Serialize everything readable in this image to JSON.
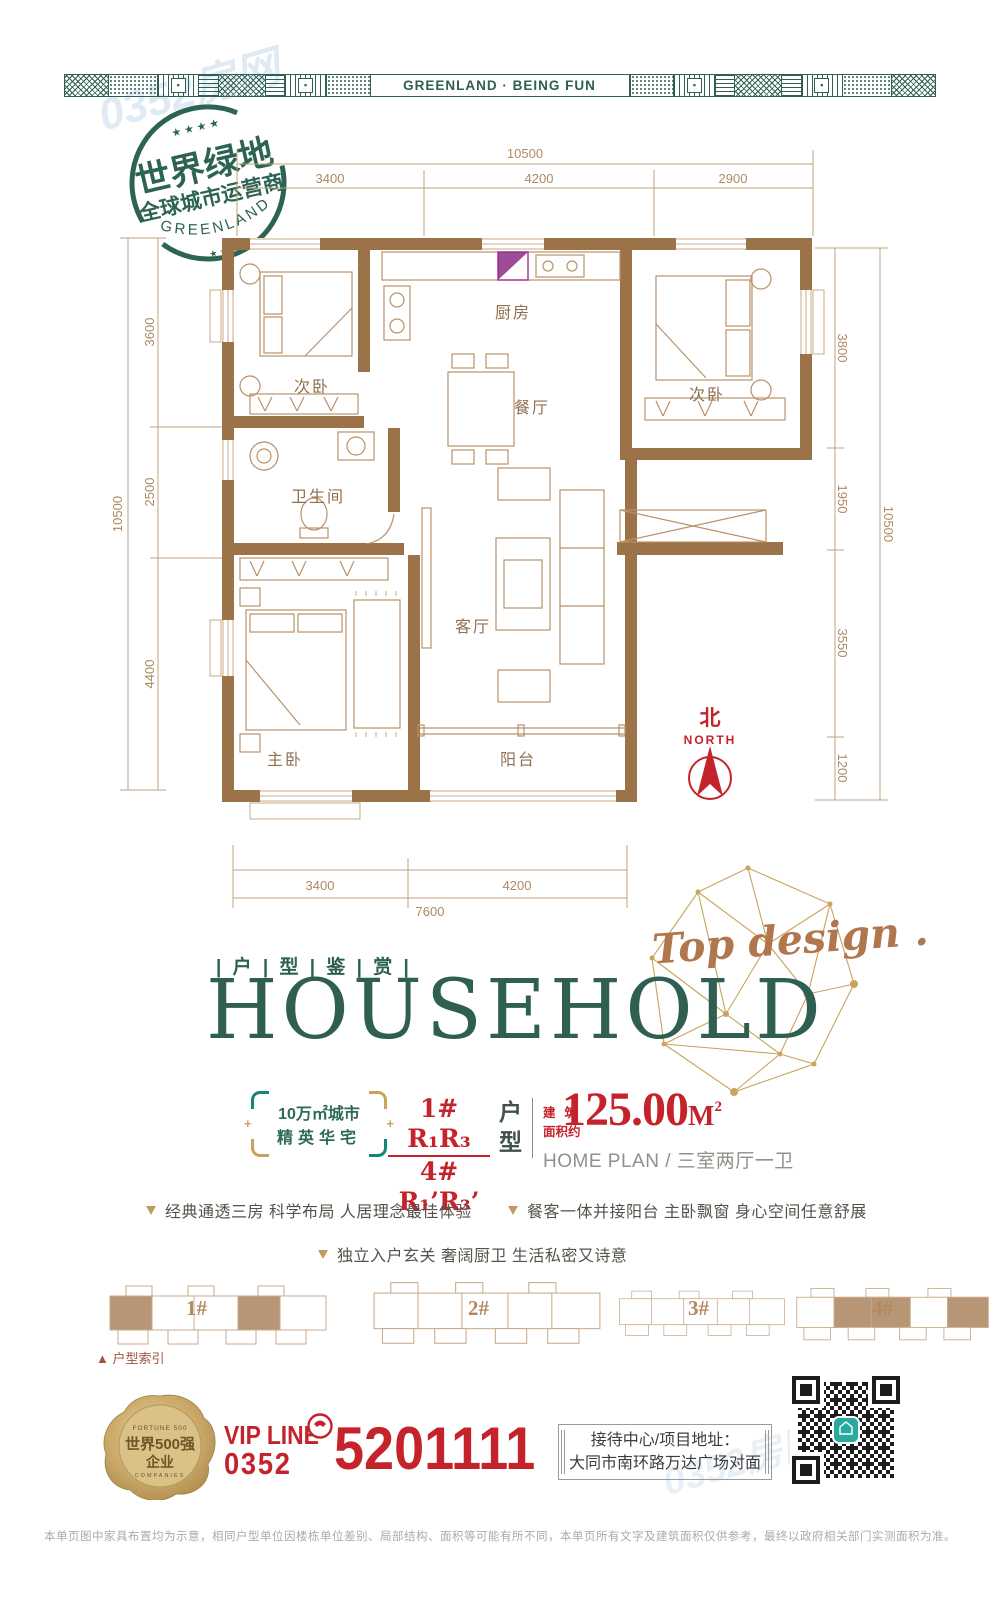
{
  "colors": {
    "brand_green": "#2e5f51",
    "teal": "#16857a",
    "gold": "#c8a35a",
    "red": "#c5232b",
    "wall_brown": "#9c7349",
    "line_brown": "#b9916a",
    "tan": "#b5875f"
  },
  "band": {
    "label": "GREENLAND · BEING FUN"
  },
  "stamp": {
    "stars_top": "★ ★ ★ ★",
    "line1": "世界绿地",
    "line2": "全球城市运营商",
    "arc": "GREENLAND",
    "stars_bottom": "★ ★ ★"
  },
  "plan": {
    "rooms": {
      "bedroom_a": "次卧",
      "kitchen": "厨房",
      "dining": "餐厅",
      "bedroom_b": "次卧",
      "bath": "卫生间",
      "living": "客厅",
      "master": "主卧",
      "balcony": "阳台"
    },
    "north": {
      "cn": "北",
      "en": "NORTH"
    },
    "dims": {
      "top_total": "10500",
      "top": [
        "3400",
        "4200",
        "2900"
      ],
      "left_total": "10500",
      "left": [
        "3600",
        "2500",
        "4400"
      ],
      "right_total": "10500",
      "right": [
        "3800",
        "1950",
        "3550",
        "1200"
      ],
      "bottom": [
        "3400",
        "4200"
      ],
      "bottom_total": "7600"
    }
  },
  "title": {
    "eyebrow": "| 户 | 型 | 鉴 | 赏 |",
    "main": "HOUSEHOLD",
    "script": "Top design ."
  },
  "spec": {
    "badge_line1": "10万㎡城市",
    "badge_line2": "精英华宅",
    "units_top": "1# R₁R₃",
    "units_bottom": "4# R₁’R₃’",
    "type_vertical_1": "户",
    "type_vertical_2": "型",
    "area_label_1": "建筑",
    "area_label_2": "面积约",
    "area_value": "125.00",
    "area_unit": "M",
    "area_sup": "2",
    "subtitle": "HOME PLAN / 三室两厅一卫"
  },
  "features": [
    "经典通透三房 科学布局 人居理念最佳体验",
    "餐客一体并接阳台 主卧飘窗 身心空间任意舒展",
    "独立入户玄关 奢阔厨卫 生活私密又诗意"
  ],
  "index": {
    "labels": [
      "1#",
      "2#",
      "3#",
      "4#"
    ],
    "caption": "▲ 户型索引"
  },
  "contact": {
    "seal_top": "FORTUNE 500",
    "seal_line1": "世界500强",
    "seal_line2": "企业",
    "seal_bottom": "COMPANIES",
    "vip": "VIP LINE",
    "area_code": "0352",
    "phone": "5201111",
    "addr_line1": "接待中心/项目地址：",
    "addr_line2": "大同市南环路万达广场对面"
  },
  "disclaimer": "本单页图中家具布置均为示意，相同户型单位因楼栋单位差别、局部结构、面积等可能有所不同，本单页所有文字及建筑面积仅供参考，最终以政府相关部门实测面积为准。",
  "watermark": "0352房网"
}
